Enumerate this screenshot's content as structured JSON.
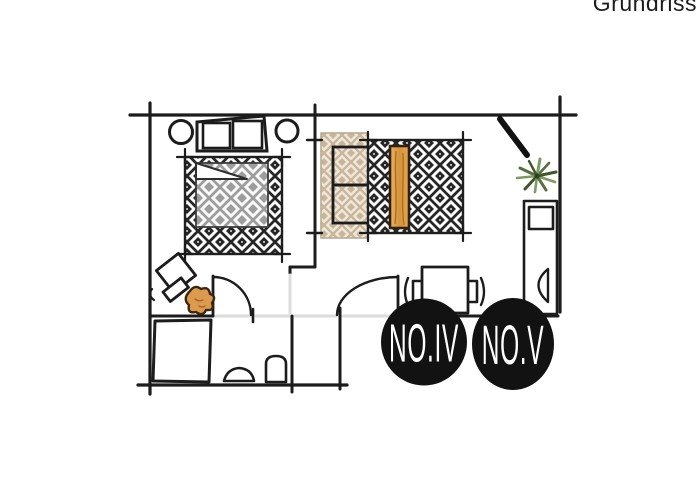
{
  "page": {
    "caption": "Grundriss",
    "background": "#ffffff"
  },
  "floorplan": {
    "badges": [
      {
        "label": "NO.IV"
      },
      {
        "label": "NO.V"
      }
    ],
    "rooms": [
      {
        "name": "bedroom-left"
      },
      {
        "name": "bedroom-right"
      },
      {
        "name": "bathroom"
      },
      {
        "name": "hallway"
      },
      {
        "name": "entry-area"
      }
    ],
    "icons": [
      "double-bed-icon",
      "pillow-icon",
      "bedside-lamp-icon",
      "patterned-rug-icon",
      "single-bed-icon",
      "wood-bench-icon",
      "wardrobe-mirror-icon",
      "door-swing-icon",
      "desk-two-chairs-icon",
      "shower-icon",
      "sink-icon",
      "toilet-icon",
      "potted-plant-icon",
      "side-chair-icon",
      "decor-blob-icon"
    ],
    "colors": {
      "ink": "#1c1c1c",
      "rug_dark": "#262626",
      "duvet_gray": "#9d9d9d",
      "duvet_beige": "#c9b69a",
      "beige_bg": "#efe8da",
      "wood": "#dfa24c",
      "plant": "#6f8f57",
      "decor_orange": "#dc9a4e",
      "badge_bg": "#121212",
      "badge_text": "#ffffff",
      "opening": "#dcdcdc"
    }
  }
}
